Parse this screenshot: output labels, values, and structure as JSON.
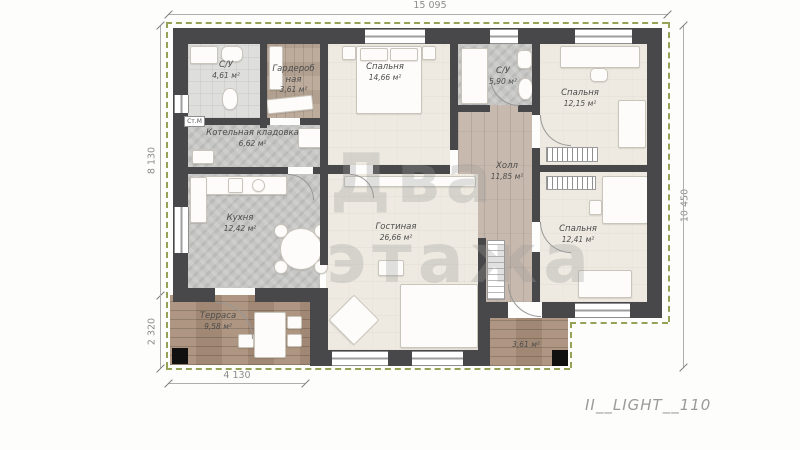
{
  "plan": {
    "code": "II__LIGHT__110",
    "watermark": {
      "line1": "Два",
      "line2": "этажа"
    },
    "dimensions": {
      "top": "15 095",
      "left_upper": "8 130",
      "left_lower": "2 320",
      "right": "10 450",
      "bottom": "4 130"
    },
    "annotations": {
      "washing_machine": "Ст.М"
    },
    "rooms": [
      {
        "name": "С/У",
        "area": "4,61 м²"
      },
      {
        "name": "Гардеробная",
        "area": "3,61 м²"
      },
      {
        "name": "Спальня",
        "area": "14,66 м²"
      },
      {
        "name": "С/У",
        "area": "5,90 м²"
      },
      {
        "name": "Спальня",
        "area": "12,15 м²"
      },
      {
        "name": "Котельная кладовка",
        "area": "6,62 м²"
      },
      {
        "name": "Кухня",
        "area": "12,42 м²"
      },
      {
        "name": "Холл",
        "area": "11,85 м²"
      },
      {
        "name": "Гостиная",
        "area": "26,66 м²"
      },
      {
        "name": "Спальня",
        "area": "12,41 м²"
      },
      {
        "name": "Терраса",
        "area": "9,58 м²"
      },
      {
        "name": "",
        "area": "3,61 м²"
      }
    ]
  }
}
